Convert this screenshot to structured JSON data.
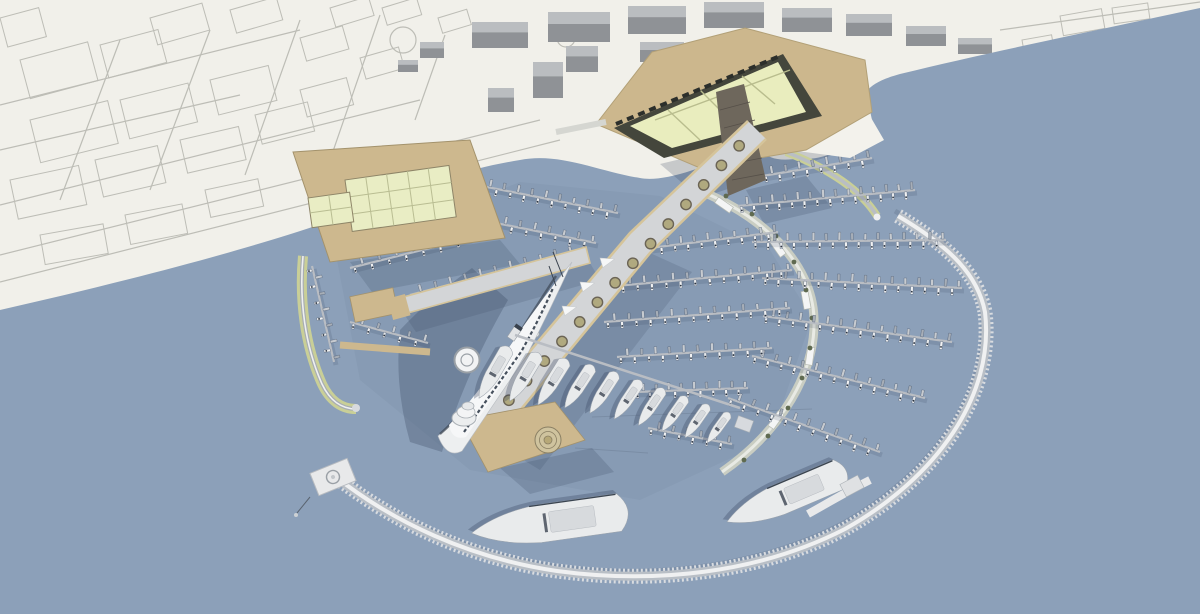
{
  "meta": {
    "width": 1200,
    "height": 614,
    "description": "aerial 3d rendering of circular marina masterplan"
  },
  "scene": {
    "colors": {
      "land": "#F1F0EA",
      "water": "#8CA0B9",
      "waterTint": "#3F4F6A",
      "sketchLine": "#BDBDB6",
      "bldg": "#8F9296",
      "bldgTop": "#BABDC0",
      "tan": "#CDB88E",
      "tanEdge": "#A3926C",
      "plaza": "#CCB78D",
      "sand": "#F3F2EC",
      "shedRoof": "#E9EDC4",
      "shedLine": "#B9BD92",
      "triDark": "#44463C",
      "glassRoof": "#E9EDBE",
      "glassLine": "#B9BD8E",
      "tower": "#6E675C",
      "ringTeeth": "#D9DCE0",
      "ringBand": "#B9BFC6",
      "ringTop": "#EFF0F1",
      "olive": "#C9CF97",
      "arc": "#C9CDC2",
      "arcTop": "#E8EAE4",
      "pier": "#B9BDC3",
      "spineDeck": "#D3D5D7",
      "spineEdge": "#D5C49A",
      "planterFill": "#B0A97F",
      "planterRing": "#6B6455",
      "tree": "#5F6A50",
      "shipWhite": "#EDEFF0",
      "shipTrim": "#F6F7F8",
      "shipWindow": "#46505D",
      "shipDark": "#39424E",
      "shadow": "#31405A",
      "boatShadow": "#4E5D73",
      "kiosk": "#F4F5F5",
      "berth": "#E8E9EA",
      "mast": "#2B3441",
      "boatPalette": [
        "#E8EAEC",
        "#C7CBD0",
        "#F1F2F3",
        "#A7AEB7"
      ]
    },
    "sketch": {
      "blocks": [
        [
          20,
          60,
          70,
          40,
          -15
        ],
        [
          100,
          45,
          60,
          34,
          -15
        ],
        [
          30,
          120,
          80,
          44,
          -14
        ],
        [
          120,
          100,
          70,
          40,
          -14
        ],
        [
          210,
          80,
          60,
          36,
          -14
        ],
        [
          10,
          180,
          70,
          40,
          -12
        ],
        [
          95,
          160,
          64,
          38,
          -13
        ],
        [
          180,
          140,
          60,
          34,
          -13
        ],
        [
          255,
          115,
          54,
          30,
          -14
        ],
        [
          300,
          90,
          48,
          28,
          -15
        ],
        [
          40,
          235,
          64,
          30,
          -10
        ],
        [
          125,
          215,
          58,
          30,
          -11
        ],
        [
          205,
          190,
          54,
          28,
          -12
        ],
        [
          150,
          18,
          54,
          28,
          -16
        ],
        [
          230,
          10,
          48,
          24,
          -16
        ],
        [
          300,
          38,
          44,
          24,
          -16
        ],
        [
          360,
          58,
          40,
          22,
          -16
        ],
        [
          0,
          18,
          40,
          30,
          -15
        ],
        [
          330,
          8,
          40,
          20,
          -17
        ],
        [
          382,
          8,
          36,
          18,
          -17
        ],
        [
          1060,
          16,
          42,
          20,
          -10
        ],
        [
          1112,
          8,
          36,
          16,
          -8
        ],
        [
          1022,
          40,
          30,
          14,
          -10
        ],
        [
          438,
          18,
          30,
          16,
          -17
        ]
      ],
      "streets": [
        [
          0,
          255,
          540,
          120
        ],
        [
          0,
          282,
          560,
          140
        ],
        [
          0,
          205,
          420,
          100
        ],
        [
          0,
          105,
          300,
          30
        ],
        [
          120,
          40,
          60,
          200
        ],
        [
          210,
          30,
          150,
          190
        ],
        [
          300,
          20,
          245,
          175
        ],
        [
          380,
          15,
          330,
          160
        ],
        [
          445,
          35,
          415,
          120
        ],
        [
          0,
          150,
          240,
          95
        ],
        [
          980,
          60,
          1200,
          18
        ],
        [
          1000,
          30,
          1200,
          2
        ]
      ],
      "roundabouts": [
        [
          403,
          40,
          13
        ],
        [
          566,
          38,
          9
        ]
      ]
    },
    "buildings3d": [
      [
        472,
        22,
        56,
        26
      ],
      [
        548,
        12,
        62,
        30
      ],
      [
        628,
        6,
        58,
        28
      ],
      [
        704,
        2,
        60,
        26
      ],
      [
        782,
        8,
        50,
        24
      ],
      [
        846,
        14,
        46,
        22
      ],
      [
        906,
        26,
        40,
        20
      ],
      [
        958,
        38,
        34,
        16
      ],
      [
        640,
        42,
        44,
        20
      ],
      [
        714,
        36,
        40,
        18
      ],
      [
        566,
        46,
        32,
        26
      ],
      [
        533,
        62,
        30,
        36
      ],
      [
        488,
        88,
        26,
        24
      ],
      [
        420,
        42,
        24,
        16
      ],
      [
        398,
        60,
        20,
        12
      ]
    ],
    "piers": [
      [
        762,
        176,
        872,
        158,
        16,
        7
      ],
      [
        738,
        206,
        915,
        190,
        28,
        7
      ],
      [
        752,
        242,
        946,
        240,
        30,
        7
      ],
      [
        762,
        278,
        962,
        288,
        30,
        7
      ],
      [
        763,
        316,
        952,
        342,
        28,
        7
      ],
      [
        752,
        356,
        925,
        398,
        26,
        7
      ],
      [
        728,
        398,
        880,
        452,
        22,
        7
      ],
      [
        618,
        252,
        778,
        232,
        24,
        6.5
      ],
      [
        605,
        287,
        792,
        270,
        26,
        6.5
      ],
      [
        604,
        322,
        790,
        308,
        26,
        6.5
      ],
      [
        617,
        357,
        772,
        348,
        22,
        6.5
      ],
      [
        634,
        392,
        748,
        388,
        18,
        6.5
      ],
      [
        648,
        428,
        732,
        444,
        12,
        6.5
      ],
      [
        452,
        180,
        618,
        213,
        24,
        6.5
      ],
      [
        436,
        211,
        596,
        243,
        22,
        6.5
      ],
      [
        410,
        295,
        575,
        252,
        22,
        6.5
      ],
      [
        350,
        268,
        470,
        238,
        14,
        6
      ],
      [
        312,
        266,
        334,
        362,
        12,
        6
      ],
      [
        350,
        322,
        428,
        343,
        10,
        6
      ]
    ],
    "yachtPier": [
      515,
      335,
      740,
      408
    ],
    "yachts": [
      [
        508,
        348,
        58,
        30
      ],
      [
        538,
        354,
        55,
        31
      ],
      [
        566,
        360,
        53,
        32
      ],
      [
        592,
        366,
        50,
        33
      ],
      [
        616,
        373,
        48,
        33
      ],
      [
        640,
        381,
        46,
        34
      ],
      [
        663,
        389,
        44,
        34
      ],
      [
        686,
        397,
        42,
        35
      ],
      [
        708,
        405,
        40,
        35
      ],
      [
        729,
        413,
        37,
        36
      ],
      [
        842,
        473,
        125,
        67,
        "super"
      ],
      [
        622,
        512,
        152,
        82,
        "super"
      ]
    ],
    "circleRows": [
      [
        748,
        136,
        500,
        410,
        14,
        5.2,
        "planter"
      ],
      [
        578,
        258,
        414,
        300,
        8,
        4.2,
        "planter"
      ],
      [
        474,
        424,
        540,
        328,
        8,
        3.4,
        "deck"
      ]
    ],
    "arcTrees": [
      [
        700,
        180
      ],
      [
        726,
        196
      ],
      [
        752,
        214
      ],
      [
        776,
        236
      ],
      [
        794,
        262
      ],
      [
        806,
        290
      ],
      [
        812,
        318
      ],
      [
        810,
        348
      ],
      [
        802,
        378
      ],
      [
        788,
        408
      ],
      [
        768,
        436
      ],
      [
        744,
        460
      ]
    ],
    "canopies": [
      [
        470,
        282,
        -15
      ],
      [
        500,
        274,
        -15
      ],
      [
        530,
        266,
        -15
      ],
      [
        556,
        259,
        -15
      ],
      [
        600,
        258,
        20
      ],
      [
        580,
        282,
        20
      ],
      [
        562,
        306,
        20
      ]
    ],
    "kiosks": [
      [
        724,
        205,
        35
      ],
      [
        778,
        248,
        55
      ],
      [
        806,
        300,
        80
      ],
      [
        810,
        356,
        98
      ],
      [
        776,
        420,
        125
      ]
    ],
    "streaks": [
      [
        575,
        448,
        648,
        453
      ],
      [
        592,
        417,
        812,
        409
      ]
    ]
  }
}
